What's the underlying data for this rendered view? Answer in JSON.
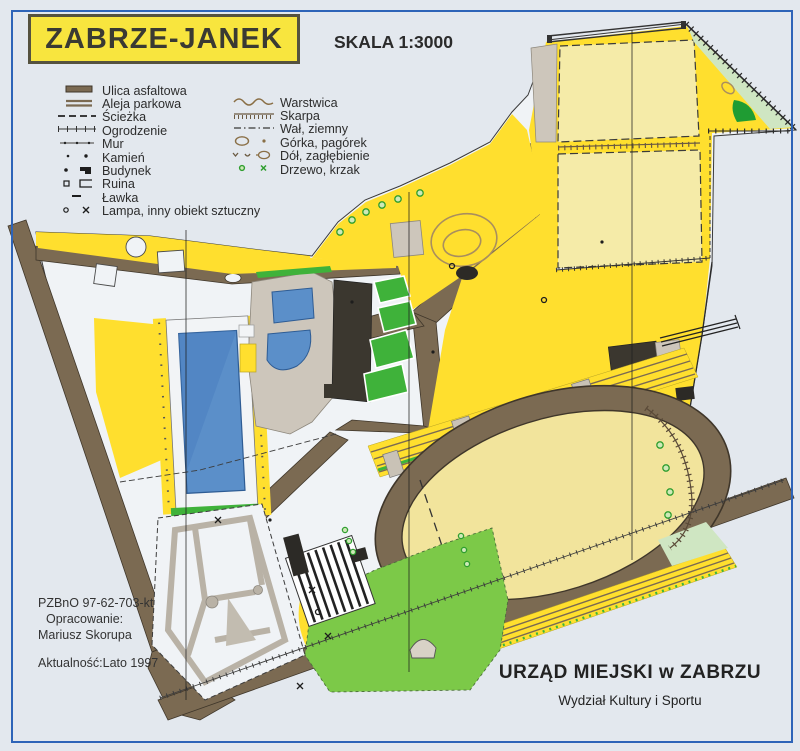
{
  "title": "ZABRZE-JANEK",
  "scale": "SKALA 1:3000",
  "legend": {
    "left": [
      {
        "label": "Ulica asfaltowa",
        "icon": "asphalt-road"
      },
      {
        "label": "Aleja parkowa",
        "icon": "park-alley"
      },
      {
        "label": "Ścieżka",
        "icon": "footpath"
      },
      {
        "label": "Ogrodzenie",
        "icon": "fence"
      },
      {
        "label": "Mur",
        "icon": "wall"
      },
      {
        "label": "Kamień",
        "icon": "stone"
      },
      {
        "label": "Budynek",
        "icon": "building"
      },
      {
        "label": "Ruina",
        "icon": "ruin"
      },
      {
        "label": "Ławka",
        "icon": "bench"
      },
      {
        "label": "Lampa, inny obiekt sztuczny",
        "icon": "lamp-artificial-object"
      }
    ],
    "right": [
      {
        "label": "Warstwica",
        "icon": "contour"
      },
      {
        "label": "Skarpa",
        "icon": "earth-slope"
      },
      {
        "label": "Wał, ziemny",
        "icon": "earth-bank"
      },
      {
        "label": "Górka, pagórek",
        "icon": "knoll"
      },
      {
        "label": "Dół, zagłębienie",
        "icon": "depression"
      },
      {
        "label": "Drzewo, krzak",
        "icon": "tree-shrub"
      }
    ]
  },
  "credits": {
    "code": "PZBnO 97-62-703-kt",
    "prepared_label": "Opracowanie:",
    "prepared_by": "Mariusz Skorupa",
    "validity": "Aktualność:Lato 1997"
  },
  "footer": {
    "office": "URZĄD MIEJSKI w ZABRZU",
    "department": "Wydział Kultury i Sportu"
  },
  "colors": {
    "paper": "#e3e8ee",
    "frame_blue": "#2e64b8",
    "title_yellow": "#f8e53e",
    "open_yellow": "#ffdf2e",
    "pale_field": "#f5eba8",
    "road_brown": "#7b6a52",
    "pool_blue": "#5b8fc9",
    "hedge_green": "#3fb23a",
    "lawn_green": "#7cc948",
    "rough_green": "#cfe6c2",
    "building_dark": "#3b372f",
    "building_gray": "#cdc6bb"
  }
}
